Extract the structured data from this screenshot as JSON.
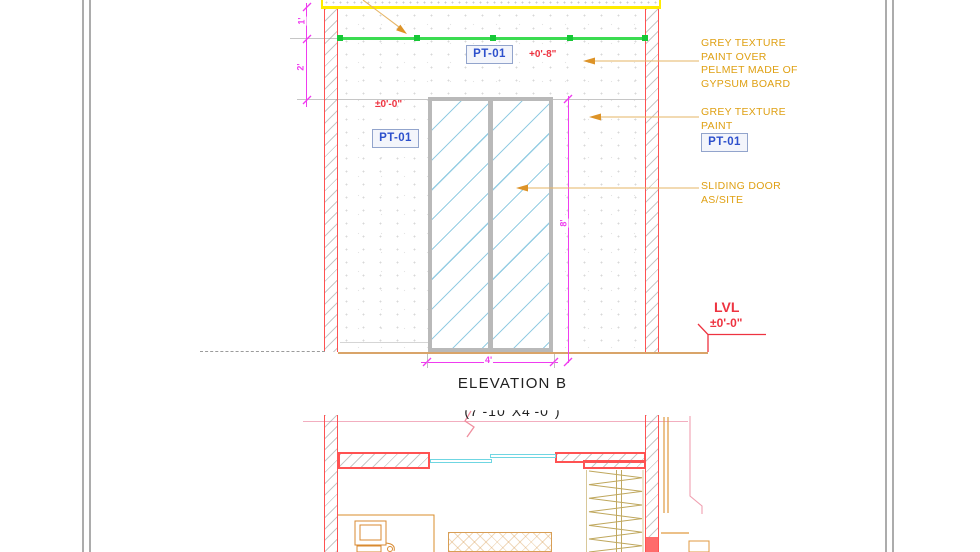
{
  "colors": {
    "wall_red": "#ff5252",
    "dim_magenta": "#ef3cef",
    "level_red": "#ee3340",
    "annotation_orange": "#dfa013",
    "leader_orange": "#e6b566",
    "pelmet_green": "#3bdc51",
    "grip_green": "#17c837",
    "ceiling_yellow": "#ffec00",
    "pt01_blue": "#2d50cc",
    "door_frame_gray": "#b9b9b9",
    "glass_blue": "#a6d9ea",
    "plan_door_cyan": "#6fd6e2",
    "floor_tan": "#d9a469",
    "plan_line_pink": "#f2aebf"
  },
  "elevation": {
    "title": "ELEVATION B",
    "size_note": "(7'-10\"X4'-0\")",
    "pt01_label": "PT-01",
    "levels": {
      "pelmet_top": "+0'-8\"",
      "door_head": "±0'-0\""
    },
    "dimensions": {
      "ceiling_to_pelmet": "1'",
      "pelmet_height": "2'",
      "door_height": "8'",
      "door_width": "4'"
    },
    "level_marker": {
      "label": "LVL",
      "value": "±0'-0\""
    },
    "annotations": {
      "pelmet_note": [
        "GREY TEXTURE",
        "PAINT OVER",
        "PELMET MADE OF",
        "GYPSUM BOARD"
      ],
      "wall_note": [
        "GREY TEXTURE",
        "PAINT"
      ],
      "door_note": [
        "SLIDING DOOR",
        "AS/SITE"
      ]
    }
  }
}
